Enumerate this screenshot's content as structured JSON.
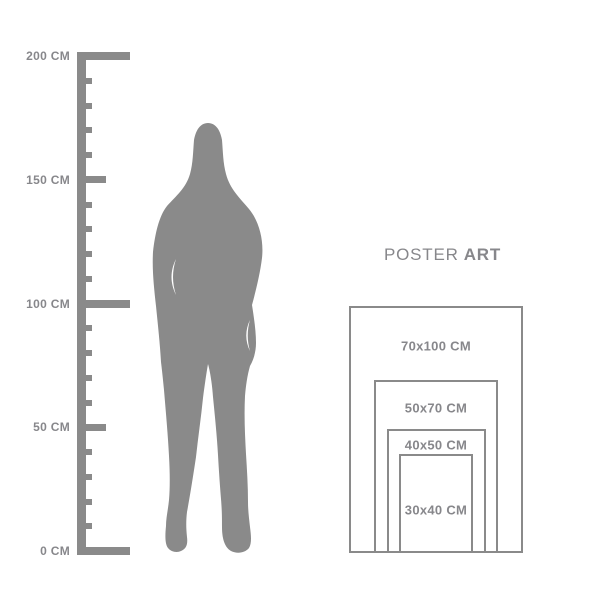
{
  "colors": {
    "background": "#ffffff",
    "shape": "#8a8a8a",
    "text": "#87878b"
  },
  "icons": {
    "silhouette": "standing-woman-silhouette"
  },
  "ruler": {
    "unit": "CM",
    "min_cm": 0,
    "max_cm": 200,
    "tick_step_cm": 10,
    "labels": [
      {
        "cm": 200,
        "text": "200 CM"
      },
      {
        "cm": 150,
        "text": "150 CM"
      },
      {
        "cm": 100,
        "text": "100 CM"
      },
      {
        "cm": 50,
        "text": "50 CM"
      },
      {
        "cm": 0,
        "text": "0 CM"
      }
    ]
  },
  "brand": {
    "name_regular": "POSTER",
    "name_bold": "ART"
  },
  "poster_sizes": [
    {
      "label": "70x100 CM",
      "width_cm": 70,
      "height_cm": 100
    },
    {
      "label": "50x70 CM",
      "width_cm": 50,
      "height_cm": 70
    },
    {
      "label": "40x50 CM",
      "width_cm": 40,
      "height_cm": 50
    },
    {
      "label": "30x40 CM",
      "width_cm": 30,
      "height_cm": 40
    }
  ]
}
